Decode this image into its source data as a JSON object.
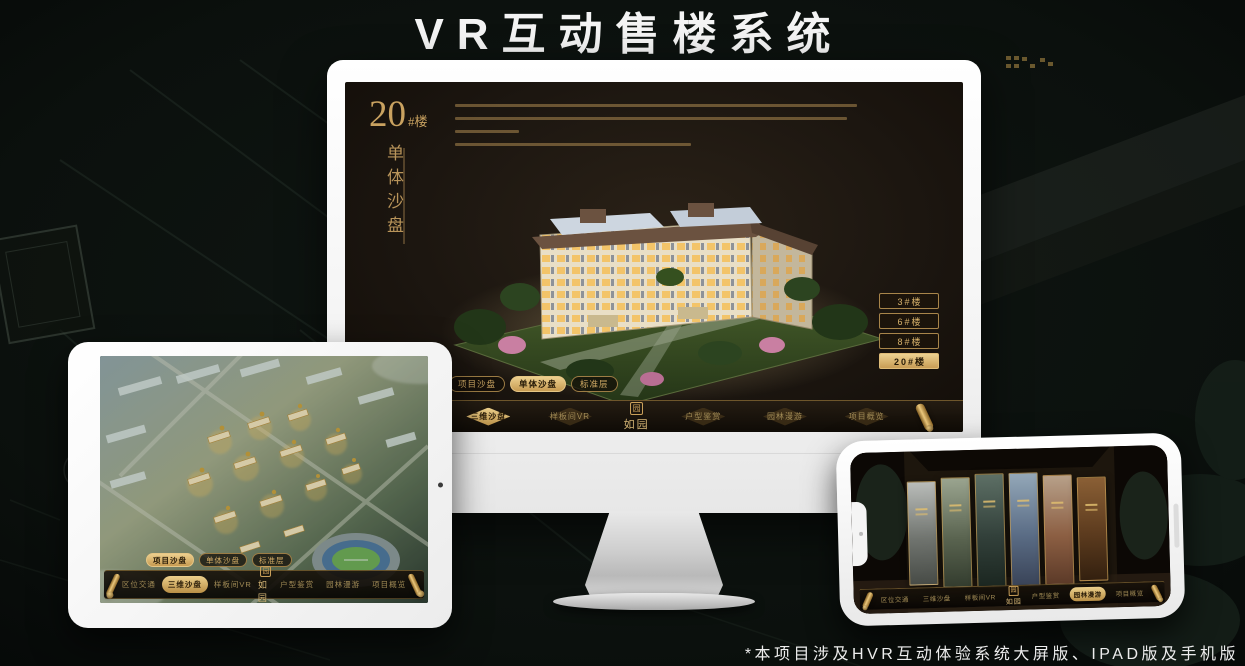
{
  "banner": {
    "title": "VR互动售楼系统"
  },
  "footnote": "*本项目涉及HVR互动体验系统大屏版、IPAD版及手机版",
  "colors": {
    "gold": "#d2ab66",
    "gold_selected_fill": "#c89d55",
    "screen_background": "#1c1610",
    "banner_text": "#f4f4f4"
  },
  "sales_app": {
    "unit_title": {
      "number": "20",
      "suffix": "#楼",
      "subtitle_vertical": "单体沙盘"
    },
    "floor_buttons": [
      {
        "label": "3#楼",
        "selected": false
      },
      {
        "label": "6#楼",
        "selected": false
      },
      {
        "label": "8#楼",
        "selected": false
      },
      {
        "label": "20#楼",
        "selected": true
      }
    ],
    "view_tabs": [
      {
        "label": "项目沙盘",
        "selected": false
      },
      {
        "label": "单体沙盘",
        "selected": true
      },
      {
        "label": "标准层",
        "selected": false
      }
    ],
    "nav": {
      "logo": {
        "seal": "园",
        "name": "如园"
      },
      "items": [
        {
          "label": "区位交通",
          "selected": false
        },
        {
          "label": "三维沙盘",
          "selected": true
        },
        {
          "label": "样板间VR",
          "selected": false
        },
        {
          "label": "户型鉴赏",
          "selected": false
        },
        {
          "label": "园林漫游",
          "selected": false
        },
        {
          "label": "项目概览",
          "selected": false
        }
      ]
    }
  },
  "ipad_app": {
    "view_tabs": [
      {
        "label": "项目沙盘",
        "selected": true
      },
      {
        "label": "单体沙盘",
        "selected": false
      },
      {
        "label": "标准层",
        "selected": false
      }
    ],
    "nav": {
      "logo": {
        "seal": "园",
        "name": "如园"
      },
      "items": [
        {
          "label": "区位交通",
          "selected": false
        },
        {
          "label": "三维沙盘",
          "selected": true
        },
        {
          "label": "样板间VR",
          "selected": false
        },
        {
          "label": "户型鉴赏",
          "selected": false
        },
        {
          "label": "园林漫游",
          "selected": false
        },
        {
          "label": "项目概览",
          "selected": false
        }
      ]
    }
  },
  "phone_app": {
    "nav": {
      "logo": {
        "seal": "园",
        "name": "如园"
      },
      "items": [
        {
          "label": "区位交通",
          "selected": false
        },
        {
          "label": "三维沙盘",
          "selected": false
        },
        {
          "label": "样板间VR",
          "selected": false
        },
        {
          "label": "户型鉴赏",
          "selected": false
        },
        {
          "label": "园林漫游",
          "selected": true
        },
        {
          "label": "项目概览",
          "selected": false
        }
      ]
    }
  }
}
